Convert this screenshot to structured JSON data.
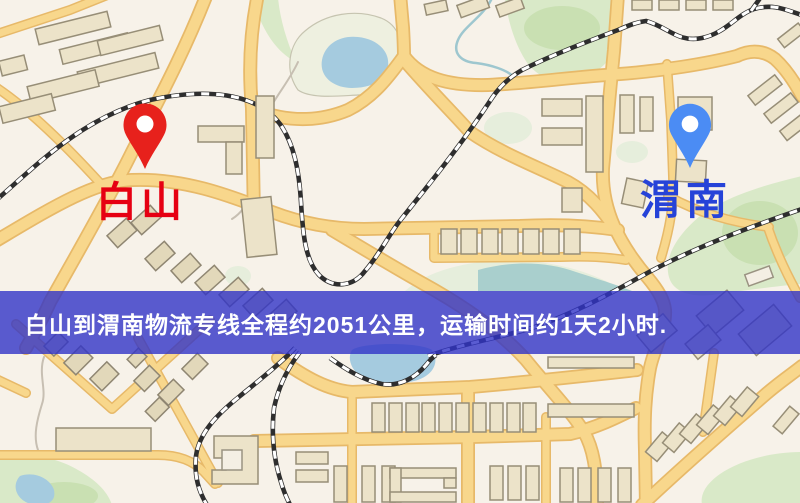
{
  "map": {
    "origin": {
      "name": "白山",
      "pin_color": "#e7211c",
      "label_color": "#e60012",
      "pin_icon": "red-map-pin-icon"
    },
    "destination": {
      "name": "渭南",
      "pin_color": "#4b8cf4",
      "label_color": "#2643d8",
      "pin_icon": "blue-map-pin-icon"
    },
    "banner": {
      "text": "白山到渭南物流专线全程约2051公里，运输时间约1天2小时.",
      "background_color": "#3133c7",
      "text_color": "#ffffff"
    },
    "route": {
      "origin": "白山",
      "destination": "渭南",
      "distance_km": 2051,
      "duration": "1天2小时"
    }
  }
}
